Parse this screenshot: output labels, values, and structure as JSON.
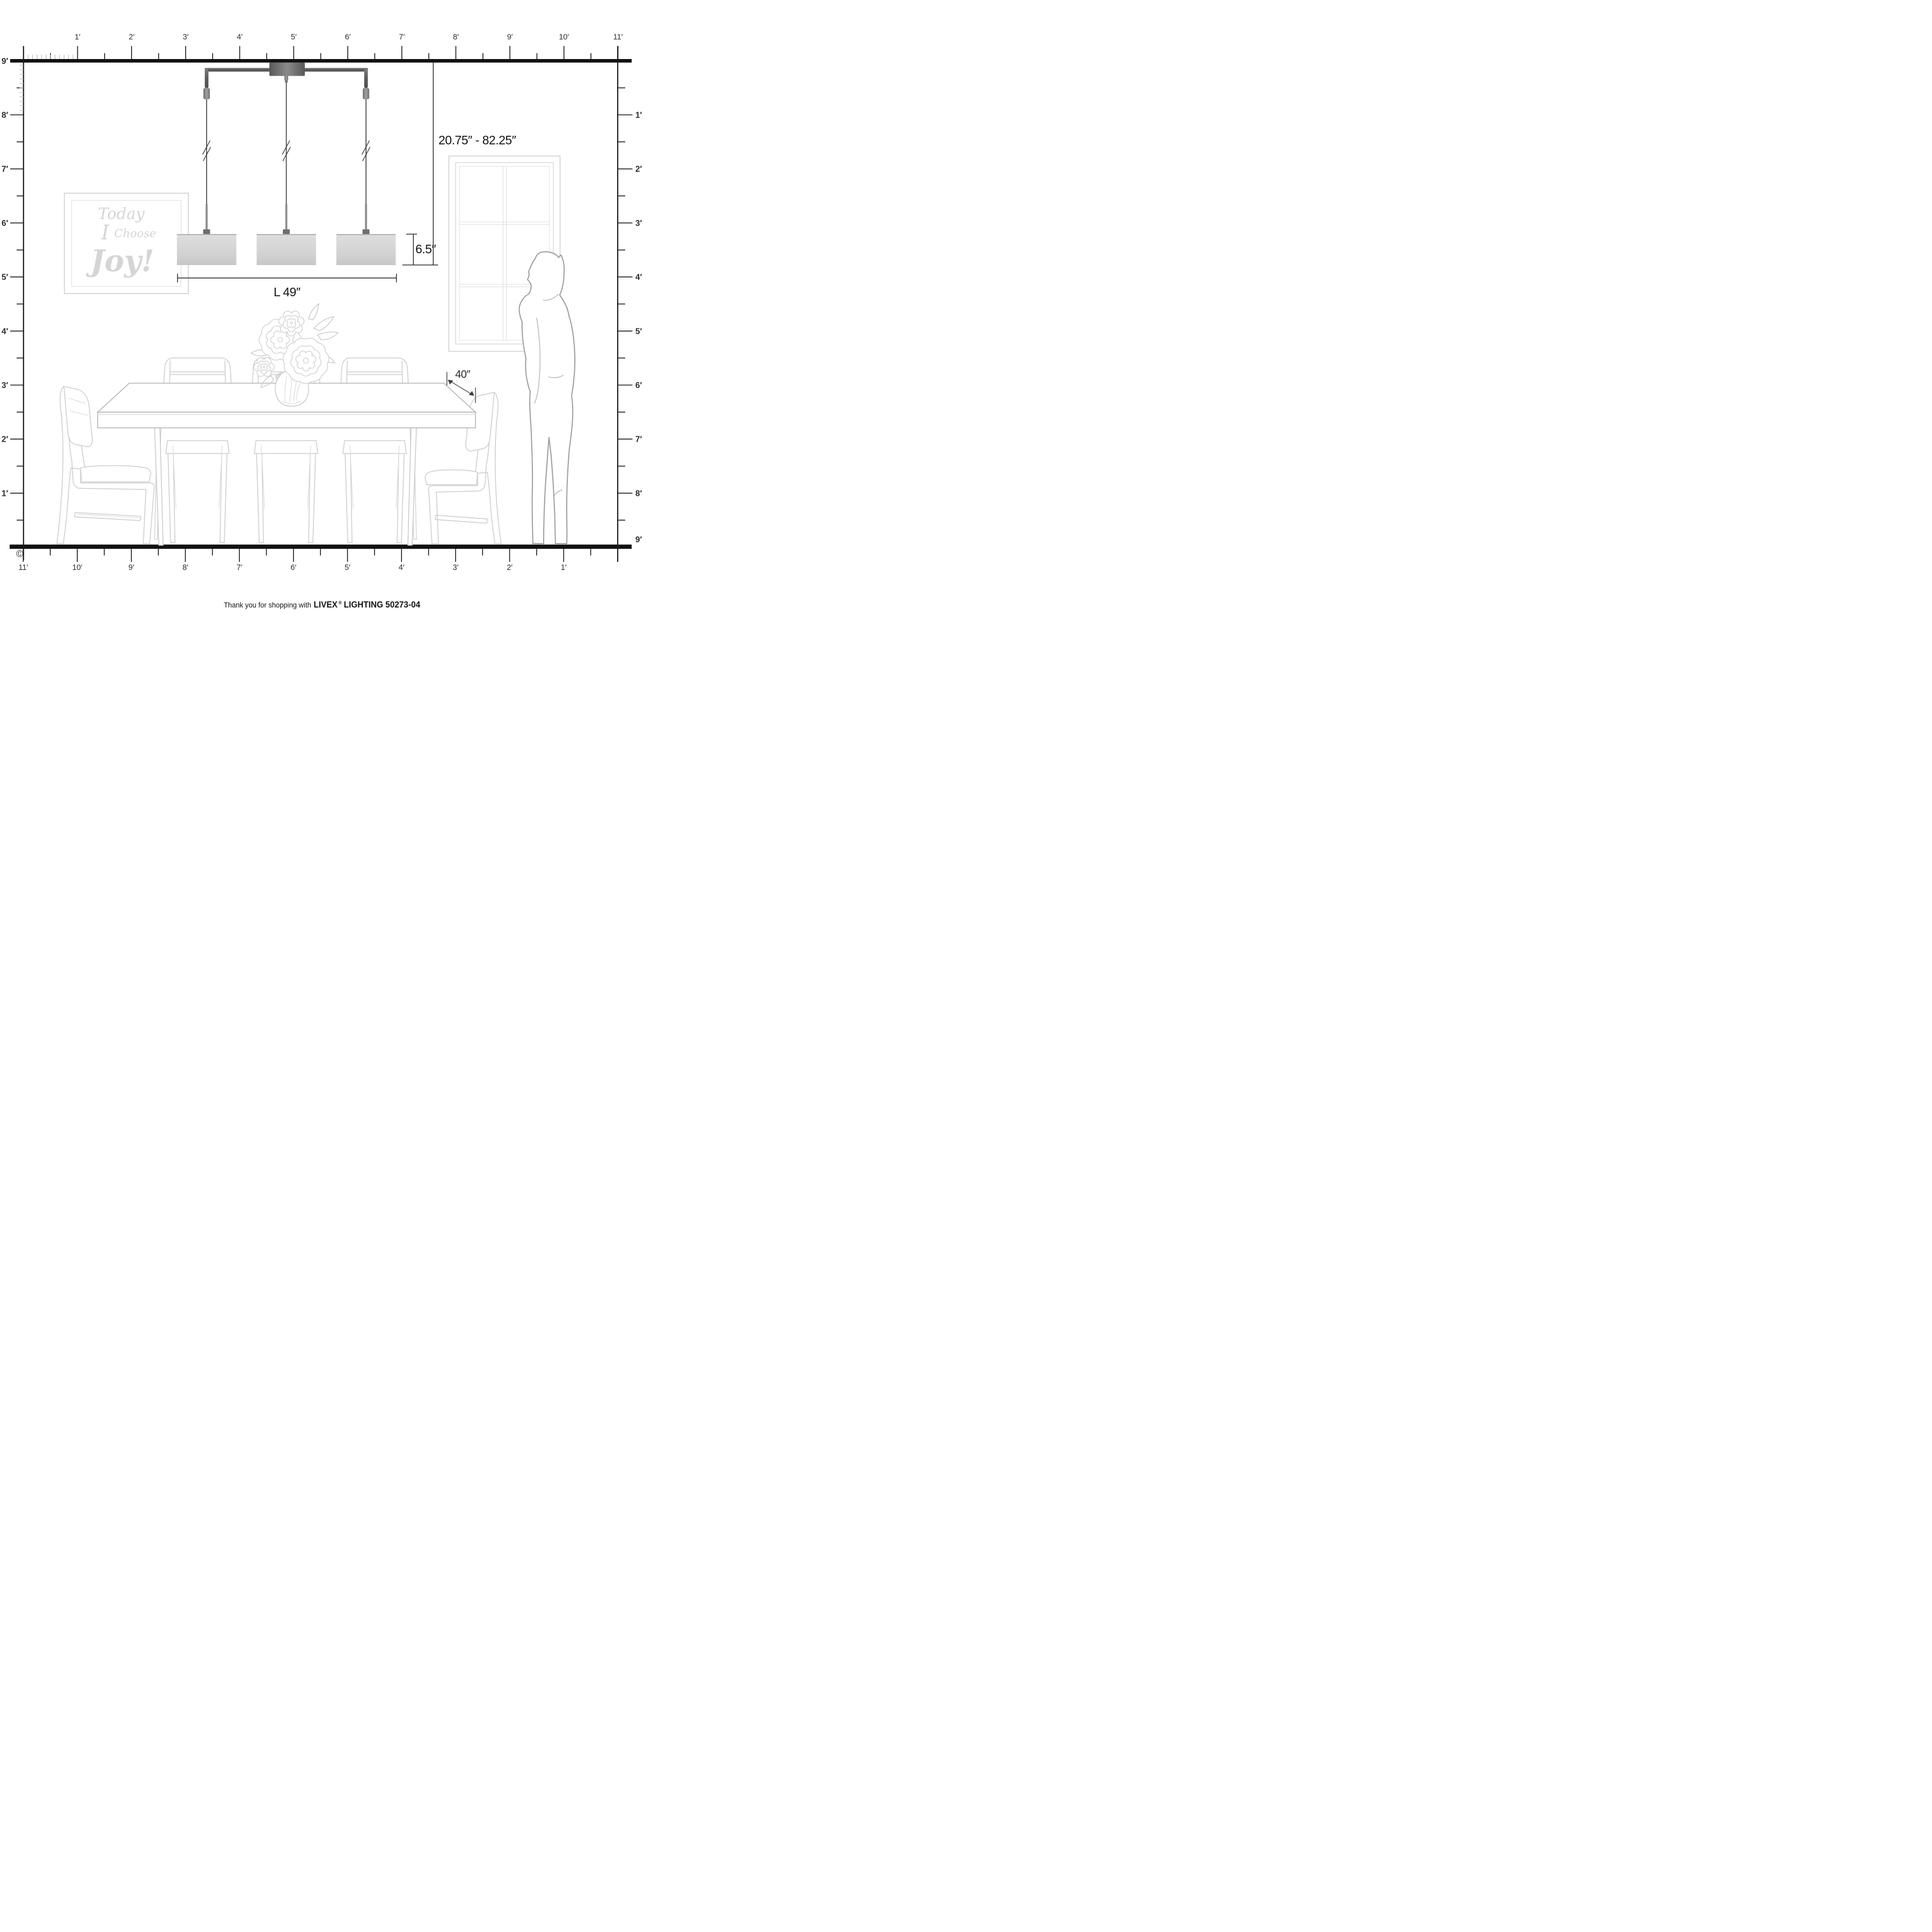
{
  "rulers": {
    "top": {
      "labels": [
        "1′",
        "2′",
        "3′",
        "4′",
        "5′",
        "6′",
        "7′",
        "8′",
        "9′",
        "10′",
        "11′"
      ]
    },
    "left": {
      "labels": [
        "9′",
        "8′",
        "7′",
        "6′",
        "5′",
        "4′",
        "3′",
        "2′",
        "1′"
      ]
    },
    "right": {
      "labels": [
        "1′",
        "2′",
        "3′",
        "4′",
        "5′",
        "6′",
        "7′",
        "8′",
        "9′"
      ]
    },
    "bottom": {
      "labels": [
        "11′",
        "10′",
        "9′",
        "8′",
        "7′",
        "6′",
        "5′",
        "4′",
        "3′",
        "2′",
        "1′"
      ]
    }
  },
  "dimensions": {
    "hanging_height_range": "20.75″ - 82.25″",
    "shade_height": "6.5″",
    "fixture_length": "L 49″",
    "table_depth": "40″"
  },
  "wall_art": {
    "line1": "Today",
    "line2_word1": "I",
    "line2_word2": "Choose",
    "line3": "Joy!"
  },
  "footer": {
    "prefix": "Thank you for shopping with",
    "brand": "LIVEX",
    "registered": "®",
    "suffix": "LIGHTING 50273-04"
  },
  "copyright": "©",
  "colors": {
    "ink": "#1d1d1d",
    "ruler_label": "#2d2d2d",
    "line_art": "#cdcdcd",
    "silhouette_outline": "#9e9e9e",
    "shade_fill": "#d7d7d7",
    "metal": "#6b6b6b",
    "cord": "#3a3a3a",
    "art_text": "#d5d5d5"
  }
}
